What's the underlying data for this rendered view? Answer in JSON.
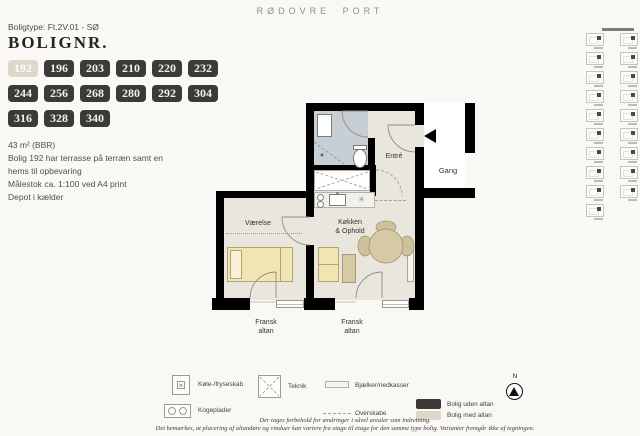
{
  "header": {
    "brand": "RØDOVRE PORT"
  },
  "unit": {
    "type_label": "Boligtype: Ft.2V.01 - SØ",
    "title": "BOLIGNR.",
    "numbers": [
      "192",
      "196",
      "203",
      "210",
      "220",
      "232",
      "244",
      "256",
      "268",
      "280",
      "292",
      "304",
      "316",
      "328",
      "340"
    ],
    "selected_number": "192",
    "details": [
      "43 m² (BBR)",
      "Bolig 192 har terrasse på terræn samt en",
      "hems til opbevaring",
      "Målestok ca. 1:100 ved A4 print",
      "Depot i kælder"
    ]
  },
  "floorplan": {
    "labels": {
      "entre": "Entré",
      "gang": "Gang",
      "vaerelse": "Værelse",
      "koekken_line1": "Køkken",
      "koekken_line2": "& Ophold",
      "altan1_line1": "Fransk",
      "altan1_line2": "altan",
      "altan2_line1": "Fransk",
      "altan2_line2": "altan"
    },
    "colors": {
      "wall": "#000000",
      "floor": "#e9e6de",
      "bathroom_floor": "#c7cfd4",
      "furniture_yellow": "#f2e5b4",
      "furniture_tan": "#d6c9a4"
    }
  },
  "legend": {
    "items": [
      {
        "icon": "fridge-icon",
        "label": "Køle-/fryseskab"
      },
      {
        "icon": "hobs-icon",
        "label": "Kogeplader"
      },
      {
        "icon": "teknik-icon",
        "label": "Teknik"
      },
      {
        "icon": "beam-icon",
        "label": "Bjælker/nedkasser"
      },
      {
        "icon": "upper-cabinets-icon",
        "label": "Overskabe"
      }
    ],
    "swatches": [
      {
        "color": "#3a3936",
        "label": "Bolig uden altan"
      },
      {
        "color": "#ddd7c8",
        "label": "Bolig med altan"
      }
    ],
    "compass_label": "N"
  },
  "footnote": {
    "line1": "Der tages forbehold for ændringer i såvel arealer som indretning.",
    "line2": "Det bemærkes, at placering af altandøre og vinduer kan variere fra etage til etage for den samme type bolig. Varianter fremgår ikke af tegningen."
  },
  "sidebar": {
    "left_column_count": 10,
    "right_column_count": 9
  }
}
